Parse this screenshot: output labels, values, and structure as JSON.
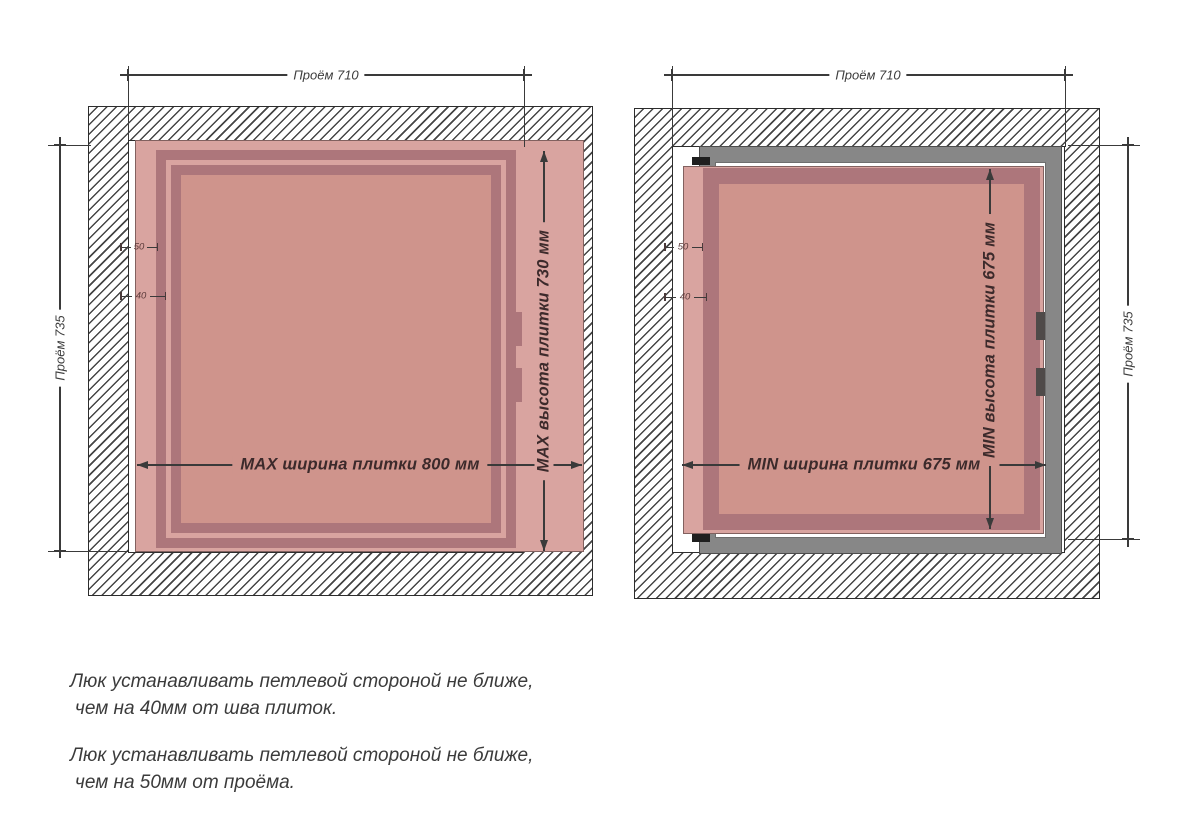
{
  "left_diagram": {
    "opening_width_label": "Проём 710",
    "opening_height_label": "Проём 735",
    "tile_width_label": "MAX ширина плитки 800 мм",
    "tile_height_label": "MAX высота плитки 730 мм",
    "hinge_offset_opening": "50",
    "hinge_offset_seam": "40"
  },
  "right_diagram": {
    "opening_width_label": "Проём 710",
    "opening_height_label": "Проём 735",
    "tile_width_label": "MIN ширина плитки 675 мм",
    "tile_height_label": "MIN высота плитки 675 мм",
    "hinge_offset_opening": "50",
    "hinge_offset_seam": "40"
  },
  "notes": [
    {
      "line1": "Люк устанавливать петлевой стороной не ближе,",
      "line2": "чем на 40мм от шва плиток."
    },
    {
      "line1": "Люк устанавливать петлевой стороной не ближе,",
      "line2": "чем на 50мм от проёма."
    }
  ],
  "colors": {
    "tile": "#d9a4a0",
    "tile_center": "#cf948c",
    "hatch_frame": "#ad767b",
    "metal_frame": "#878787",
    "dimension_lines": "#3a3a3a"
  }
}
